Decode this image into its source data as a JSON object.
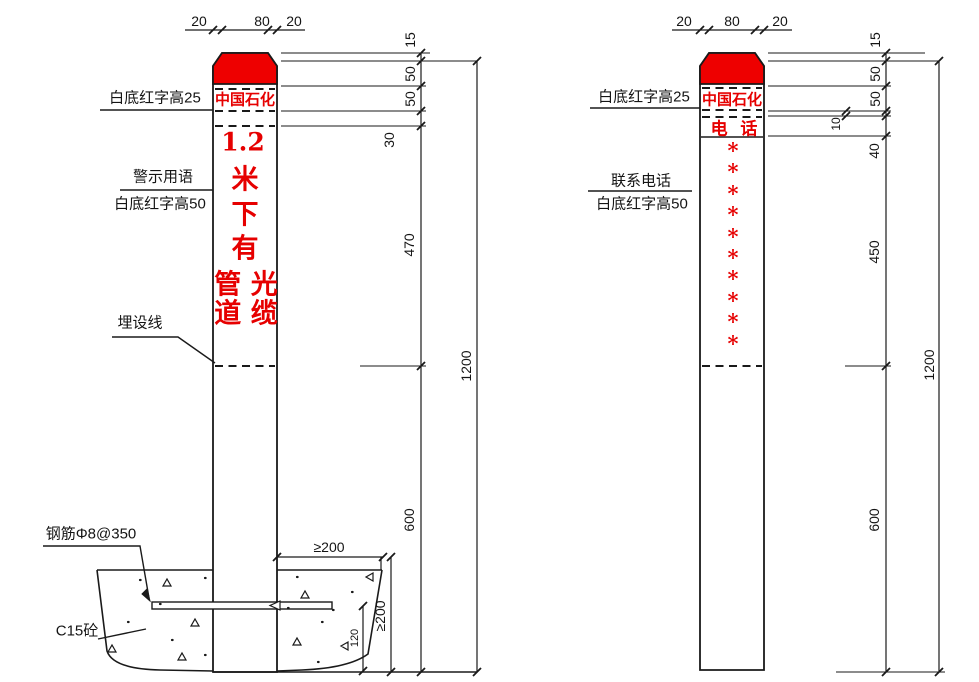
{
  "colors": {
    "red": "#ee0000",
    "line": "#1a1a1a"
  },
  "left_post": {
    "top_dims": {
      "a": "20",
      "b": "80",
      "c": "20"
    },
    "cap_label": "白底红字高25",
    "brand": "中国石化",
    "warning_label_top": "警示用语",
    "warning_label_bottom": "白底红字高50",
    "warning_text": {
      "l1": "1.2",
      "l2": "米",
      "l3": "下",
      "l4": "有",
      "l5": "管 光",
      "l6": "道 缆"
    },
    "burial_label": "埋设线",
    "rebar_label": "钢筋Φ8@350",
    "concrete_label": "C15砼",
    "dims": {
      "d15": "15",
      "d50a": "50",
      "d50b": "50",
      "d30": "30",
      "d470": "470",
      "d600": "600",
      "d1200": "1200",
      "found_w": "≥200",
      "found_h": "≥200",
      "d120": "120"
    }
  },
  "right_post": {
    "top_dims": {
      "a": "20",
      "b": "80",
      "c": "20"
    },
    "cap_label": "白底红字高25",
    "brand": "中国石化",
    "phone_word": "电 话",
    "phone_label_top": "联系电话",
    "phone_label_bottom": "白底红字高50",
    "phone_placeholder": "*\n*\n*\n*\n*\n*\n*\n*\n*\n*",
    "dims": {
      "d15": "15",
      "d50a": "50",
      "d50b": "50",
      "d10": "10",
      "d40": "40",
      "d450": "450",
      "d600": "600",
      "d1200": "1200"
    }
  }
}
